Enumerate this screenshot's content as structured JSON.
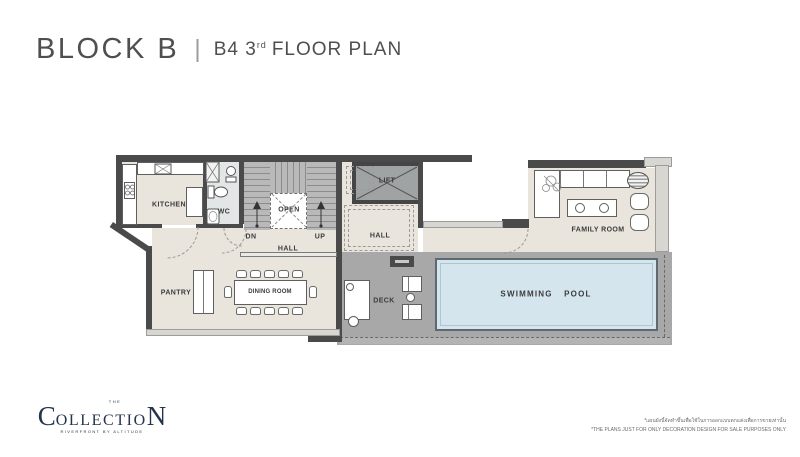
{
  "header": {
    "block_title": "BLOCK B",
    "divider": "|",
    "floor_prefix": "B4 3",
    "floor_ordinal": "rd",
    "floor_suffix": "FLOOR PLAN"
  },
  "plan": {
    "rooms": {
      "kitchen": "KITCHEN",
      "wc": "WC",
      "open": "OPEN",
      "dn": "DN",
      "up": "UP",
      "hall_center": "HALL",
      "hall_upper": "HALL",
      "lift": "LIFT",
      "family_room": "FAMILY ROOM",
      "pantry": "PANTRY",
      "dining_room": "DINING ROOM",
      "deck": "DECK",
      "swimming_pool": "SWIMMING POOL"
    },
    "colors": {
      "wall_dark": "#4a4a4a",
      "wall_light": "#d8d6d1",
      "floor_beige": "#e9e5dd",
      "stair_gray": "#b9b9b9",
      "lift_gray": "#9fa3a3",
      "deck_gray": "#a8a8a8",
      "pool_blue": "#d4e5ee",
      "pool_border": "#5d6a72",
      "wc_floor": "#e2e6e7"
    }
  },
  "footer": {
    "logo": {
      "the": "THE",
      "name_first": "C",
      "name_middle": "OLLECTIO",
      "name_last": "N",
      "tagline": "RIVERFRONT BY ALTITUDE",
      "color": "#24344e"
    },
    "disclaimer": {
      "line_thai": "*แผนผังนี้จัดทำขึ้นเพื่อใช้ในการออกแบบตกแต่งเพื่อการขายเท่านั้น",
      "line_english": "*THE PLANS JUST FOR ONLY DECORATION DESIGN FOR SALE PURPOSES ONLY"
    }
  }
}
